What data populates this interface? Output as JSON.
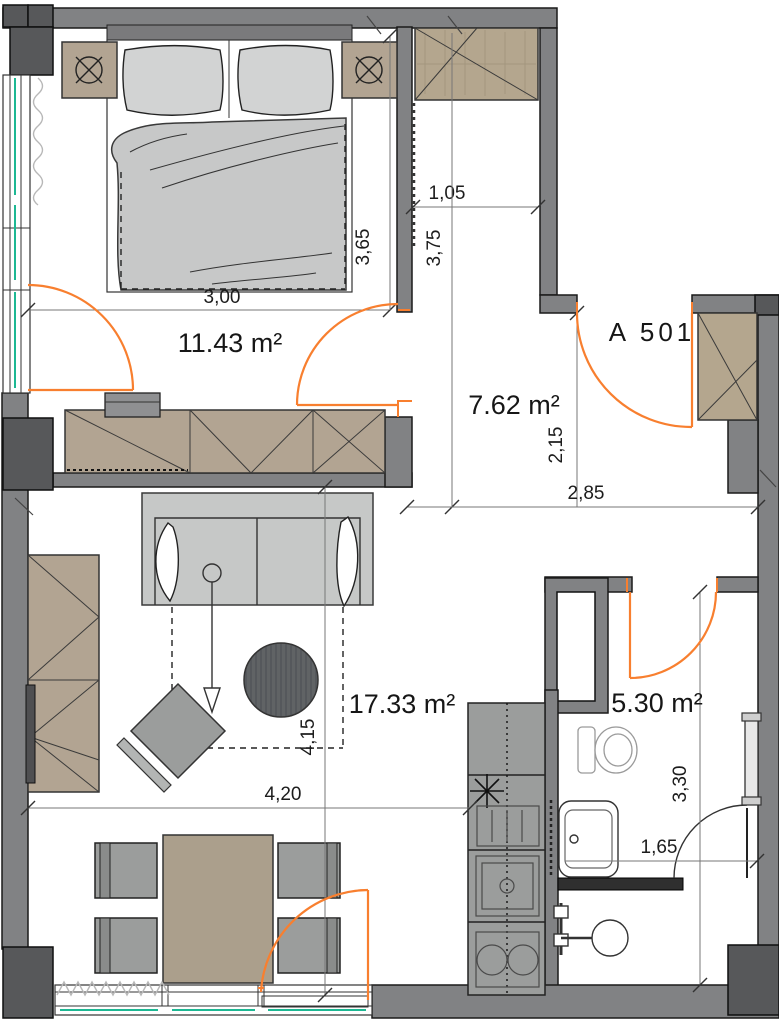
{
  "plan": {
    "apartment_label": "A 501",
    "rooms": {
      "bedroom": {
        "area": "11.43 m²"
      },
      "hall": {
        "area": "7.62 m²"
      },
      "living": {
        "area": "17.33 m²"
      },
      "bathroom": {
        "area": "5.30 m²"
      }
    },
    "dimensions": {
      "bedroom_width": "3,00",
      "bedroom_depth": "3,65",
      "niche_width": "1,05",
      "hall_depth": "3,75",
      "entry_depth": "2,15",
      "hall_width": "2,85",
      "living_depth": "4,15",
      "living_width": "4,20",
      "bath_depth": "3,30",
      "bath_width": "1,65"
    },
    "colors": {
      "wall": "#818284",
      "wall_dark": "#57585a",
      "furniture_wood": "#b2a492",
      "fabric": "#c7c8c8",
      "door_swing": "#f87f2f",
      "glazing": "#1db893"
    }
  }
}
